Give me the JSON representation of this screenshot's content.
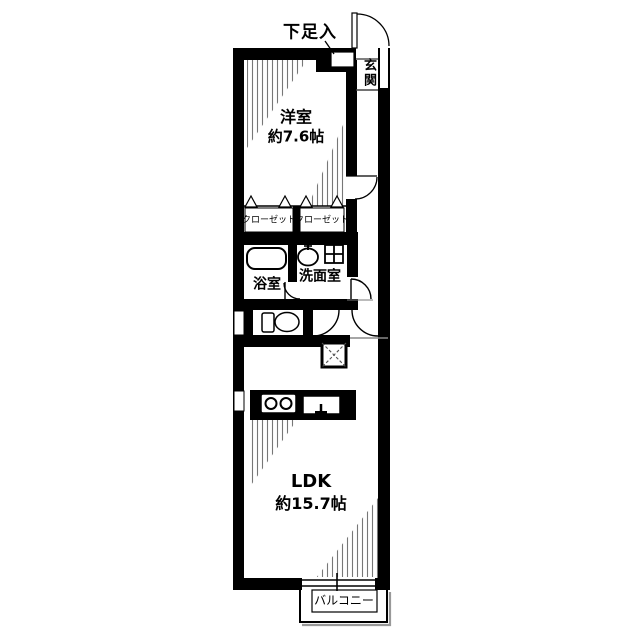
{
  "plan": {
    "title": "apartment-floor-plan",
    "labels": {
      "shoe_storage": "下足入",
      "entrance": "玄関",
      "western_room": {
        "name": "洋室",
        "size": "約7.6帖"
      },
      "closet_left": "クローゼット",
      "closet_right": "クローゼット",
      "bath": "浴室",
      "washroom": "洗面室",
      "ldk": {
        "name": "LDK",
        "size": "約15.7帖"
      },
      "balcony": "バルコニー"
    },
    "colors": {
      "wall": "#000000",
      "background": "#ffffff",
      "hatch": "#777777",
      "shadow": "#999999"
    },
    "fixtures": [
      "entrance-door",
      "shoe-cabinet",
      "genkan-step",
      "closet-folding-doors",
      "bathtub",
      "washbasin",
      "washing-machine-pan",
      "toilet",
      "pipe-shaft",
      "stove-burners",
      "kitchen-sink",
      "wall-windows",
      "sliding-window",
      "balcony-railing"
    ]
  }
}
